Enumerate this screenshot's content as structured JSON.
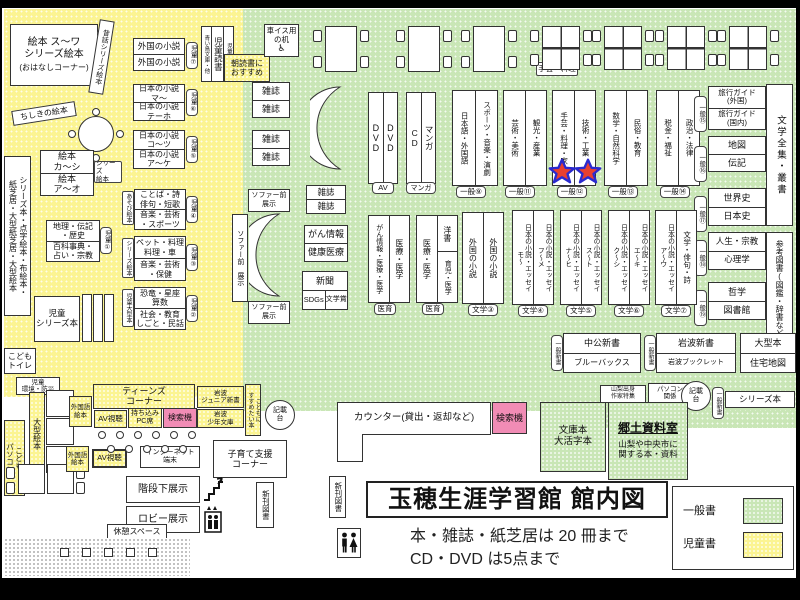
{
  "colors": {
    "children_floor": "#FBF492",
    "general_floor": "#C9E6B6",
    "search_pink": "#F18CB5",
    "star_red": "#E8402F",
    "star_outline": "#2A2ACF"
  },
  "legend": {
    "general_label": "一般書",
    "children_label": "児童書"
  },
  "title_block": {
    "title": "玉穂生涯学習館 館内図",
    "note1": "本・雑誌・紙芝居は 20 冊まで",
    "note2": "CD・DVD は5点まで",
    "shinkan": "新刊図書"
  },
  "counter": {
    "label": "カウンター(貸出・返却など)",
    "search": "検索機"
  },
  "children": {
    "ehon_main": "絵本 ス〜ワ\nシリーズ絵本",
    "ohanashi": "(おはなしコーナー)",
    "mukashi": "昔話シリーズ絵本",
    "chishiki": "ちしきの絵本",
    "shelf7": {
      "top": "外国の小説",
      "bottom": "外国の小説",
      "badge": "児童⑦"
    },
    "shelf6": {
      "top": "日本の小説\nマ〜",
      "bottom": "日本の小説\nテーホ",
      "badge": "児童⑥"
    },
    "shelf5": {
      "top": "日本の小説\nコ〜ツ",
      "bottom": "日本の小説\nア〜ケ",
      "badge": "児童⑤"
    },
    "shelf4": {
      "tag": "あそび絵本",
      "top": "ことば・詩\n俳句・短歌",
      "bottom": "音楽・芸術\n・スポーツ",
      "badge": "児童④"
    },
    "shelf3": {
      "tag": "シリーズ絵本",
      "top": "ペット・料理\n料理・車",
      "bottom": "音楽・芸術\n・保健",
      "badge": "児童③"
    },
    "shelf2": {
      "tag": "児童大型本",
      "top": "恐竜・星座\n算数",
      "bottom": "社会・教育\nしごと・民話",
      "badge": "児童②"
    },
    "ehon_ka": {
      "top": "絵本\nカ〜シ",
      "bottom": "絵本\nア〜オ",
      "tag": "シリーズ\n絵本"
    },
    "shelf1": {
      "top": "地理・伝記\n・歴史",
      "bottom": "百科事典・\n占い・宗教",
      "badge": "児童①"
    },
    "left_strip": "シリーズ本・点字絵本・布絵本・\n紙芝居・大型紙芝居・大型絵本",
    "jido_series": "児童\nシリーズ本",
    "toilet": "こども\nトイレ",
    "kankyo": "児童\n環境・防災",
    "ogata_ehon": "大型絵本",
    "kodomo_pc": "こども\nパソコン",
    "bunko_tags": {
      "left": "青い鳥文庫・他",
      "center": "児童読書",
      "right": "児童文庫"
    },
    "asadoku": "朝読書に\nおすすめ"
  },
  "teens": {
    "corner": "ティーンズ\nコーナー",
    "gaikokugo": "外国語\n絵本",
    "av": "AV視聴",
    "mochikomi": "持ち込み\nPC席",
    "search": "検索機",
    "iwanami_jr": "岩波\nジュニア新書",
    "iwanami_shonen": "岩波\n少年文庫",
    "susume": "こどもに\nすすめたい本",
    "kisaidai": "記載\n台",
    "internet": "インターネット\n端末",
    "kosodate": "子育て支援\nコーナー",
    "kaidan": "階段下展示",
    "lobby": "ロビー展示",
    "kyukei": "休憩スペース",
    "shinkan": "新刊図書"
  },
  "general": {
    "wheelchair_desk": "車イス用\nの机",
    "zasshi": "雑誌",
    "sofa_front": "ソファー前\n展示",
    "sofa_front_v": "ソファー前 展示",
    "gan_top": "がん情報",
    "gan_bottom": "健康医療",
    "shinbun": "新聞",
    "sdgs": "SDGs",
    "bungakusho": "文学賞",
    "av_pair": {
      "col1": "DVD",
      "col2": "DVD",
      "badge": "AV"
    },
    "cd_pair": {
      "col1": "CD",
      "col2": "マンガ",
      "badge": "マンガ"
    },
    "g9": {
      "col1": "日本語・外国語",
      "col2": "スポーツ・音楽・演劇",
      "badge": "一般⑨"
    },
    "g11": {
      "col1": "芸術・美術",
      "col2": "観光・産業",
      "badge": "一般⑪"
    },
    "g12": {
      "col1": "手芸・料理・家",
      "col2": "技術・工業",
      "badge": "一般⑫"
    },
    "craft_tag": "手芸・料理",
    "g13": {
      "col1": "数学・自然科学",
      "col2": "民俗・教育",
      "badge": "一般⑬"
    },
    "g14": {
      "col1": "税金・福祉",
      "col2": "政治・法律",
      "badge": "一般⑭"
    },
    "g15": {
      "badge": "一般⑮",
      "top": "旅行ガイド\n(外国)",
      "bottom": "旅行ガイド\n(国内)"
    },
    "g16": {
      "badge": "一般⑯",
      "top": "地図",
      "bottom": "伝記"
    },
    "g17": {
      "badge": "一般⑰",
      "top": "世界史",
      "bottom": "日本史"
    },
    "g18": {
      "badge": "一般⑱",
      "top": "人生・宗教",
      "bottom": "心理学"
    },
    "g19": {
      "badge": "一般⑲",
      "top": "哲学",
      "bottom": "図書館"
    },
    "bungaku_zenshu": "文学全集・叢書",
    "sanko": "参考図書(図鑑・辞書など)",
    "med1": {
      "col1": "がん情報・医療・医学",
      "col2": "医療・医学",
      "badge": "医育"
    },
    "med2": {
      "col1": "医療・医学",
      "col2_top": "洋書",
      "col2_bottom": "育児・医学",
      "badge": "医育"
    },
    "lit3": {
      "col1": "外国の小説",
      "col2": "外国の小説",
      "badge": "文学③"
    },
    "lit4": {
      "col1": "日本の小説・エッセイ\nモ〜",
      "col2": "日本の小説・エッセイ\nフ〜メ",
      "badge": "文学④"
    },
    "lit5": {
      "col1": "日本の小説・エッセイ\nナ〜ヒ",
      "col2": "日本の小説・エッセイ\nス〜ト",
      "badge": "文学⑤"
    },
    "lit6": {
      "col1": "日本の小説・エッセイ\nク〜シ",
      "col2": "日本の小説・エッセイ\nエ〜キ",
      "badge": "文学⑥"
    },
    "lit7": {
      "col1": "日本の小説・エッセイ\nア〜ウ",
      "col2": "文学・俳句・詩",
      "badge": "文学⑦"
    },
    "shinsho_badge": "一般新書",
    "chuko": {
      "top": "中公新書",
      "bottom": "ブルーバックス"
    },
    "iwanami": {
      "top": "岩波新書",
      "bottom": "岩波ブックレット"
    },
    "ogata": {
      "top": "大型本",
      "bottom": "住宅地図"
    },
    "yamanashi": "山梨出身\n作家特集",
    "pc_kankei": "パソコン\n関係",
    "kisaidai": "記載\n台",
    "series_bon": "シリーズ本",
    "bunkobon": "文庫本\n大活字本",
    "kyodo_title": "郷土資料室",
    "kyodo_desc": "山梨や中央市に\n関する本・資料"
  }
}
